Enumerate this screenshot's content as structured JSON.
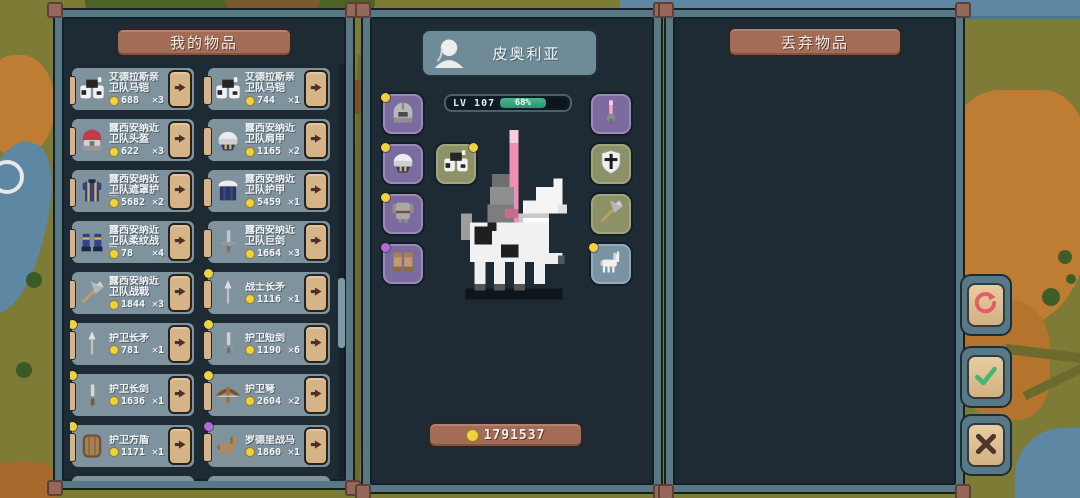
{
  "inventory_panel": {
    "title": "我的物品",
    "columns": [
      [
        {
          "name": "艾德拉斯亲卫队马铠",
          "price": "688",
          "qty_label": "✕3",
          "icon": "horse-armor-icon",
          "dot": "none"
        },
        {
          "name": "露西安纳近卫队头盔",
          "price": "622",
          "qty_label": "✕3",
          "icon": "red-helmet-icon",
          "dot": "none"
        },
        {
          "name": "露西安纳近卫队遮罩护甲",
          "price": "5682",
          "qty_label": "✕2",
          "icon": "blue-surcoat-icon",
          "dot": "none"
        },
        {
          "name": "露西安纳近卫队柔纹战靴",
          "price": "78",
          "qty_label": "✕4",
          "icon": "blue-boots-icon",
          "dot": "none"
        },
        {
          "name": "露西安纳近卫队战戟",
          "price": "1844",
          "qty_label": "✕3",
          "icon": "halberd-icon",
          "dot": "none"
        },
        {
          "name": "护卫长矛",
          "price": "781",
          "qty_label": "✕1",
          "icon": "spear-icon",
          "dot": "yellow"
        },
        {
          "name": "护卫长剑",
          "price": "1636",
          "qty_label": "✕1",
          "icon": "sword-icon",
          "dot": "yellow"
        },
        {
          "name": "护卫方盾",
          "price": "1171",
          "qty_label": "✕1",
          "icon": "round-shield-icon",
          "dot": "yellow"
        }
      ],
      [
        {
          "name": "艾德拉斯亲卫队马铠",
          "price": "744",
          "qty_label": "✕1",
          "icon": "horse-armor-icon",
          "dot": "none"
        },
        {
          "name": "露西安纳近卫队肩甲",
          "price": "1165",
          "qty_label": "✕2",
          "icon": "pauldron-icon",
          "dot": "none"
        },
        {
          "name": "露西安纳近卫队护甲",
          "price": "5459",
          "qty_label": "✕1",
          "icon": "navy-armor-icon",
          "dot": "none"
        },
        {
          "name": "露西安纳近卫队巨剑",
          "price": "1664",
          "qty_label": "✕3",
          "icon": "greatsword-icon",
          "dot": "none"
        },
        {
          "name": "战士长矛",
          "price": "1116",
          "qty_label": "✕1",
          "icon": "spear-icon",
          "dot": "yellow"
        },
        {
          "name": "护卫短剑",
          "price": "1190",
          "qty_label": "✕6",
          "icon": "short-sword-icon",
          "dot": "yellow"
        },
        {
          "name": "护卫弩",
          "price": "2604",
          "qty_label": "✕2",
          "icon": "crossbow-icon",
          "dot": "yellow"
        },
        {
          "name": "罗德里战马",
          "price": "1860",
          "qty_label": "✕1",
          "icon": "brown-horse-icon",
          "dot": "purple"
        }
      ]
    ]
  },
  "character_panel": {
    "name": "皮奥利亚",
    "level_label": "LV 107",
    "progress_percent": 68,
    "progress_label": "68%",
    "gold_label": "1791537",
    "equipment_left": [
      {
        "icon": "helmet-icon",
        "dot": "yellow",
        "style": "purple"
      },
      {
        "icon": "pauldron-icon",
        "dot": "yellow",
        "style": "purple"
      },
      {
        "icon": "chest-armor-icon",
        "dot": "yellow",
        "style": "purple"
      },
      {
        "icon": "boots-icon",
        "dot": "purple",
        "style": "purple"
      }
    ],
    "barding_slot": {
      "icon": "horse-armor-icon",
      "dot": "yellow",
      "dot_pos": "tr",
      "style": "olive"
    },
    "equipment_right": [
      {
        "icon": "lance-icon",
        "dot": "none",
        "style": "purple"
      },
      {
        "icon": "cross-shield-icon",
        "dot": "none",
        "style": "olive"
      },
      {
        "icon": "halberd-icon",
        "dot": "none",
        "style": "olive"
      },
      {
        "icon": "horse-icon",
        "dot": "yellow",
        "style": "blue"
      }
    ]
  },
  "discard_panel": {
    "title": "丢弃物品"
  },
  "action_buttons": [
    {
      "name": "refresh-button",
      "icon": "refresh-icon"
    },
    {
      "name": "confirm-button",
      "icon": "check-icon"
    },
    {
      "name": "cancel-button",
      "icon": "x-icon"
    }
  ],
  "colors": {
    "panel_border": "#597885",
    "panel_bg": "#1e2b34",
    "brown_button": "#a26c57",
    "card_bg": "#7e939e",
    "tan": "#d7b488",
    "progress_green": "#3aa87f",
    "coin_yellow": "#ecd23f",
    "dot_yellow": "#eed23f",
    "dot_purple": "#b46ad8",
    "refresh_red": "#e25d68",
    "check_green": "#49b56f",
    "x_brown": "#4d372c",
    "map_olive": "#7d7b36",
    "map_orange": "#bf7c33",
    "map_river": "#5d87a2"
  }
}
